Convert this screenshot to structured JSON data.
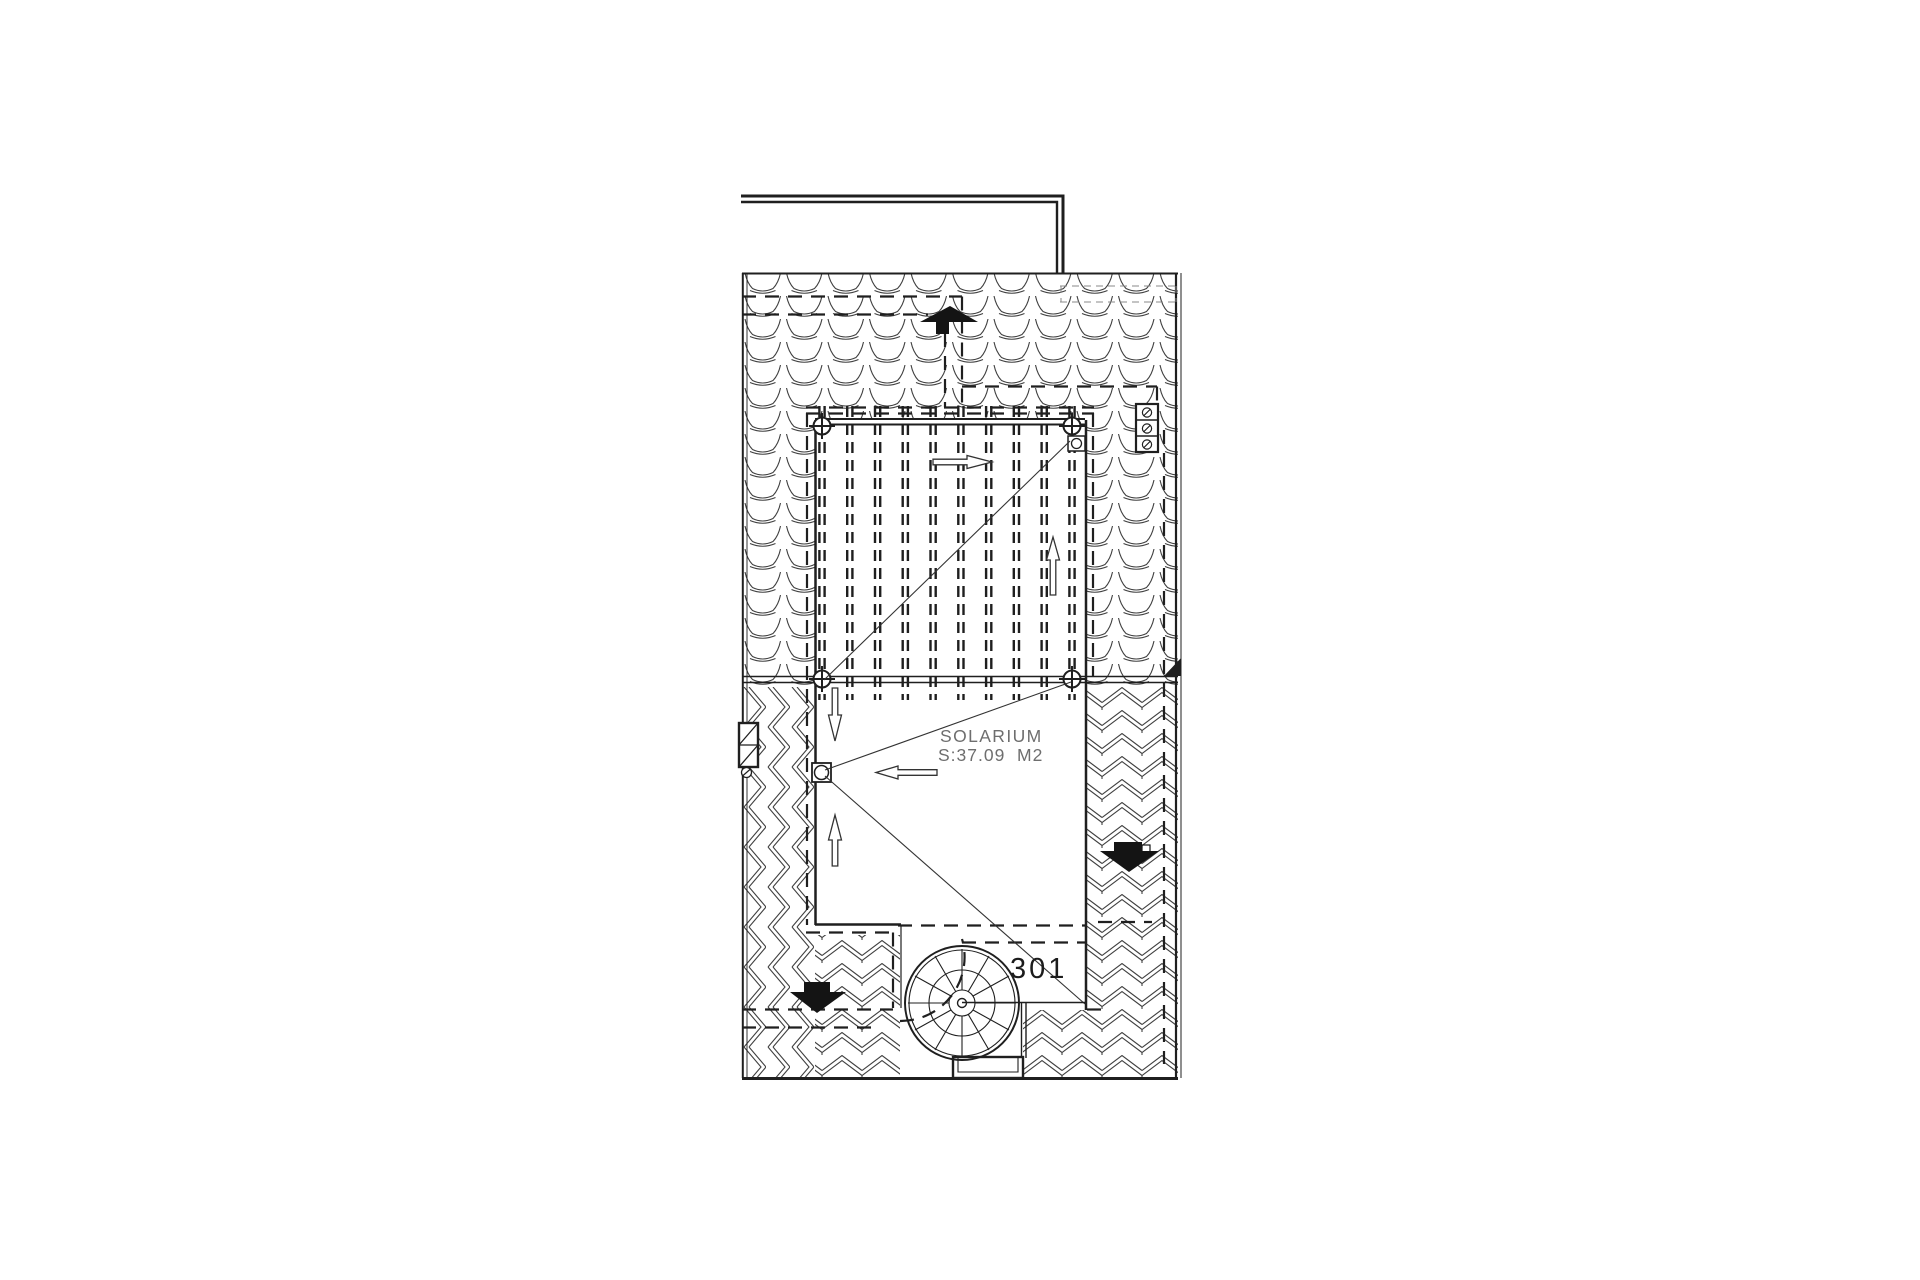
{
  "page": {
    "background": "#ffffff",
    "title": "roof-solarium-floor-plan"
  },
  "plan": {
    "labels": {
      "room_name": "SOLARIUM",
      "room_area": "S:37.09  M2",
      "unit_number": "301"
    },
    "colors": {
      "line": "#1f1f1f",
      "tile_line": "#404040",
      "muted_text": "#6e6e6e",
      "dark_text": "#1c1c1c",
      "background": "#ffffff"
    },
    "symbols": {
      "staircase": "spiral-staircase",
      "roof_drain": "roof-drain-box",
      "vent": "roof-vent-box",
      "pergola": "pergola-slats",
      "slope_arrows": [
        "up",
        "down",
        "left",
        "right"
      ]
    }
  }
}
